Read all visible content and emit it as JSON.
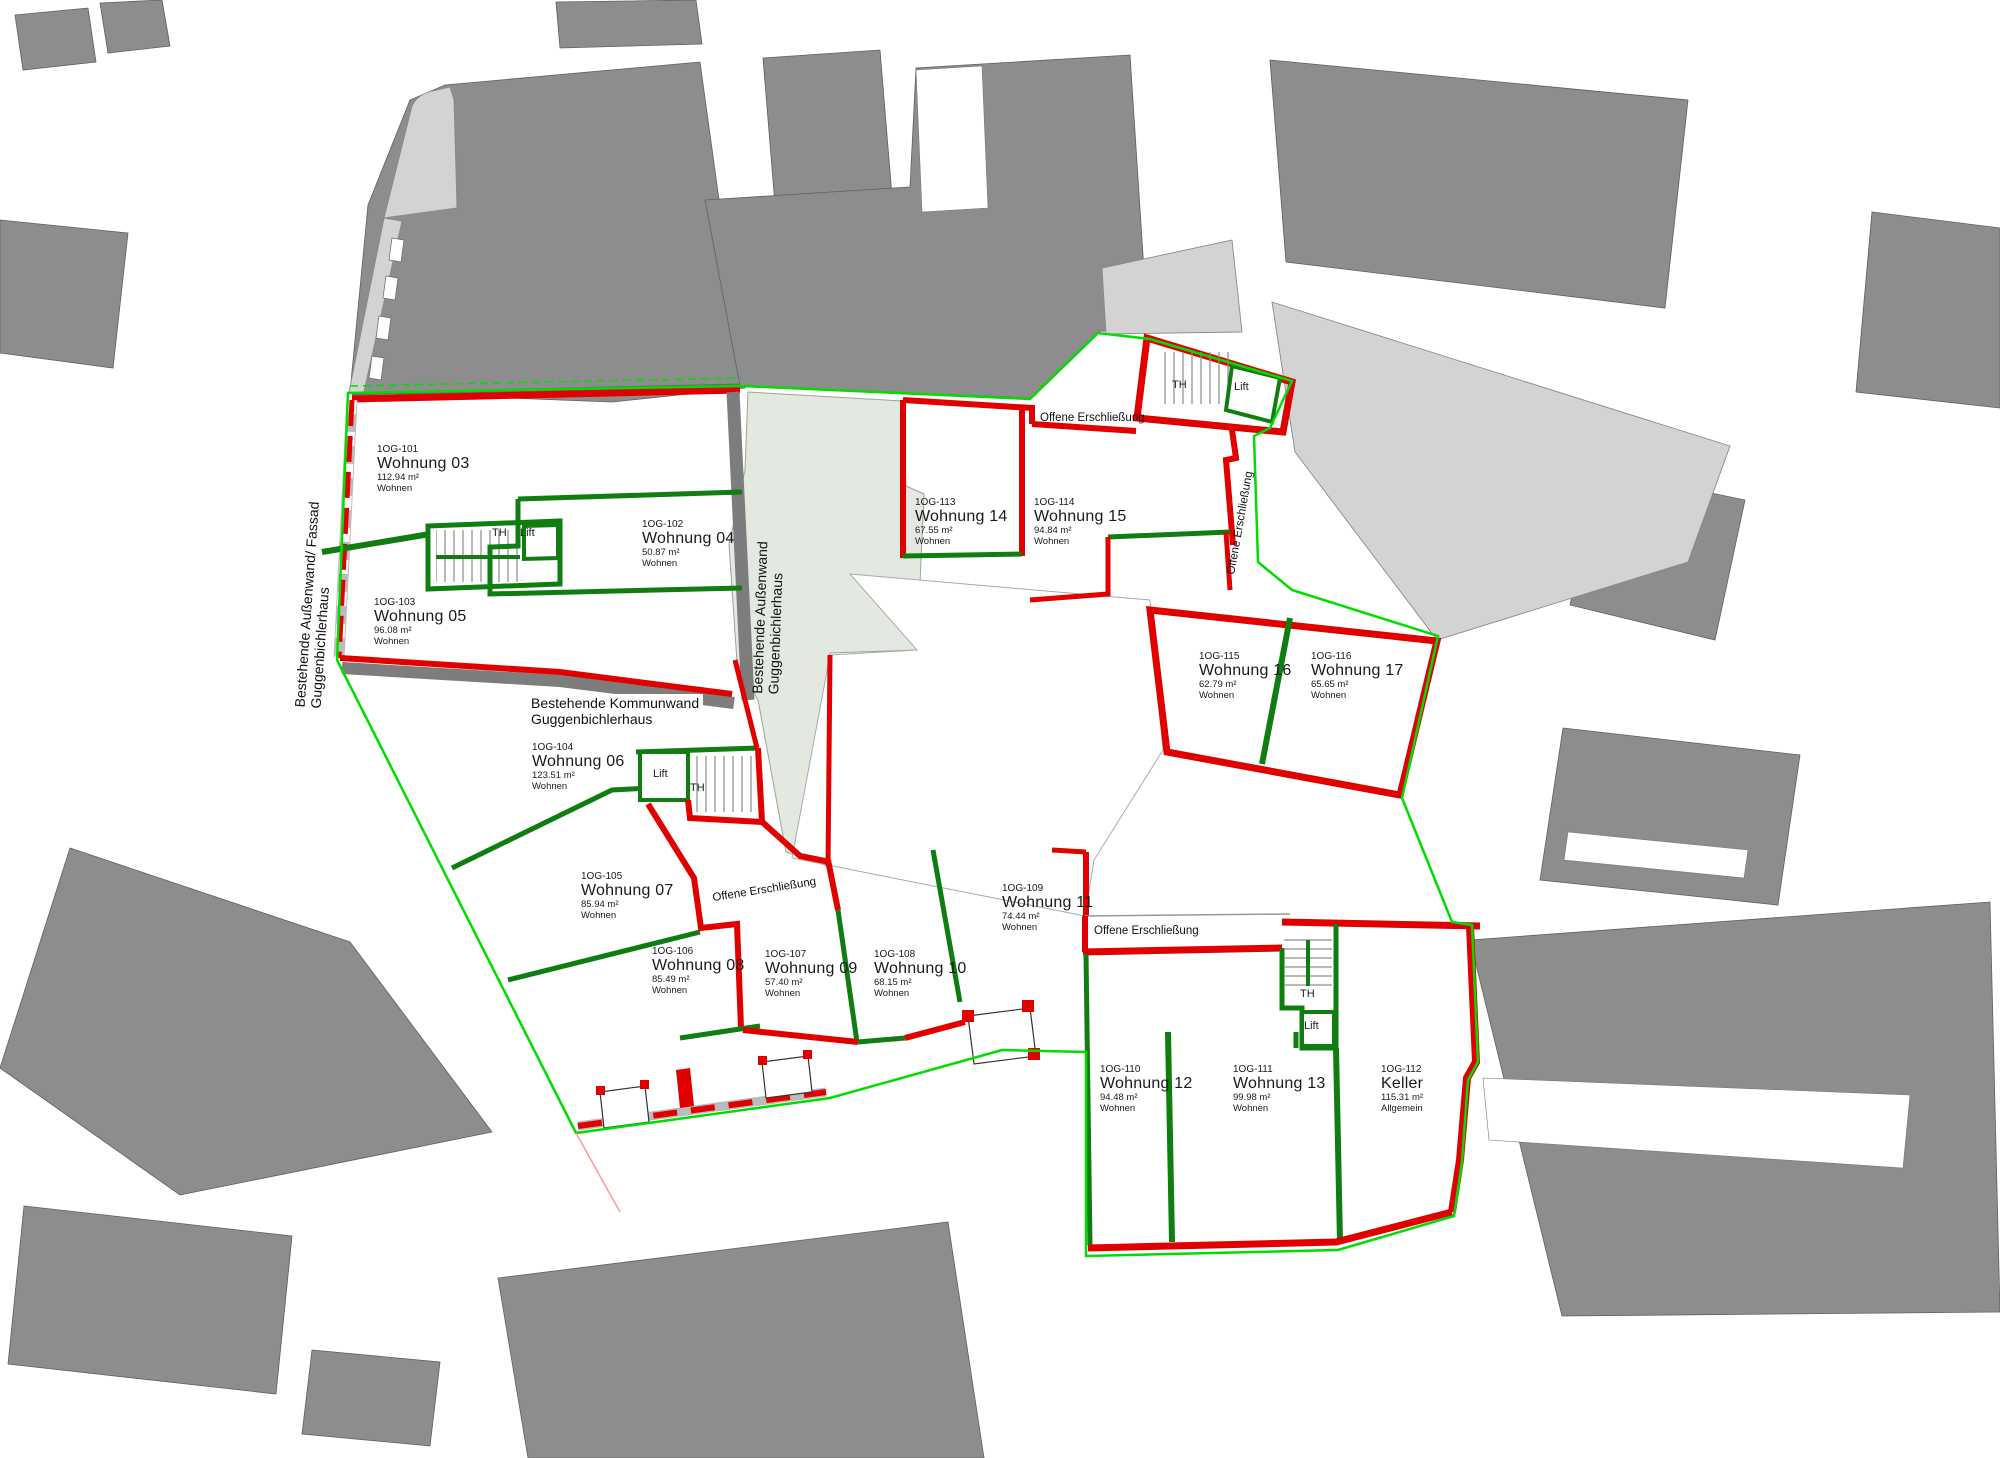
{
  "drawing": {
    "type": "floor-plan",
    "floor_code_prefix": "1OG"
  },
  "labels": {
    "th": "TH",
    "lift": "Lift",
    "offene": "Offene Erschließung"
  },
  "annotations": {
    "aussenwand_fassad_line1": "Bestehende Außenwand/ Fassad",
    "aussenwand_fassad_line2": "Guggenbichlerhaus",
    "aussenwand_line1": "Bestehende Außenwand",
    "aussenwand_line2": "Guggenbichlerhaus",
    "kommunwand_line1": "Bestehende Kommunwand",
    "kommunwand_line2": "Guggenbichlerhaus"
  },
  "units": [
    {
      "id": "1OG-101",
      "name": "Wohnung 03",
      "area": "112.94 m²",
      "use": "Wohnen"
    },
    {
      "id": "1OG-102",
      "name": "Wohnung 04",
      "area": "50.87 m²",
      "use": "Wohnen"
    },
    {
      "id": "1OG-103",
      "name": "Wohnung 05",
      "area": "96.08 m²",
      "use": "Wohnen"
    },
    {
      "id": "1OG-104",
      "name": "Wohnung 06",
      "area": "123.51 m²",
      "use": "Wohnen"
    },
    {
      "id": "1OG-105",
      "name": "Wohnung 07",
      "area": "85.94 m²",
      "use": "Wohnen"
    },
    {
      "id": "1OG-106",
      "name": "Wohnung 08",
      "area": "85.49 m²",
      "use": "Wohnen"
    },
    {
      "id": "1OG-107",
      "name": "Wohnung 09",
      "area": "57.40 m²",
      "use": "Wohnen"
    },
    {
      "id": "1OG-108",
      "name": "Wohnung 10",
      "area": "68.15 m²",
      "use": "Wohnen"
    },
    {
      "id": "1OG-109",
      "name": "Wohnung 11",
      "area": "74.44 m²",
      "use": "Wohnen"
    },
    {
      "id": "1OG-110",
      "name": "Wohnung 12",
      "area": "94.48 m²",
      "use": "Wohnen"
    },
    {
      "id": "1OG-111",
      "name": "Wohnung 13",
      "area": "99.98 m²",
      "use": "Wohnen"
    },
    {
      "id": "1OG-112",
      "name": "Keller",
      "area": "115.31 m²",
      "use": "Allgemein"
    },
    {
      "id": "1OG-113",
      "name": "Wohnung 14",
      "area": "67.55 m²",
      "use": "Wohnen"
    },
    {
      "id": "1OG-114",
      "name": "Wohnung 15",
      "area": "94.84 m²",
      "use": "Wohnen"
    },
    {
      "id": "1OG-115",
      "name": "Wohnung 16",
      "area": "62.79 m²",
      "use": "Wohnen"
    },
    {
      "id": "1OG-116",
      "name": "Wohnung 17",
      "area": "65.65 m²",
      "use": "Wohnen"
    }
  ],
  "colors": {
    "wall_red": "#e10000",
    "wall_green": "#107d10",
    "boundary_green": "#00dd00",
    "building_gray": "#8d8d8d",
    "building_light": "#d3d3d3",
    "existing_wall_dark": "#7d7d7d",
    "courtyard": "#e3e8e0"
  }
}
